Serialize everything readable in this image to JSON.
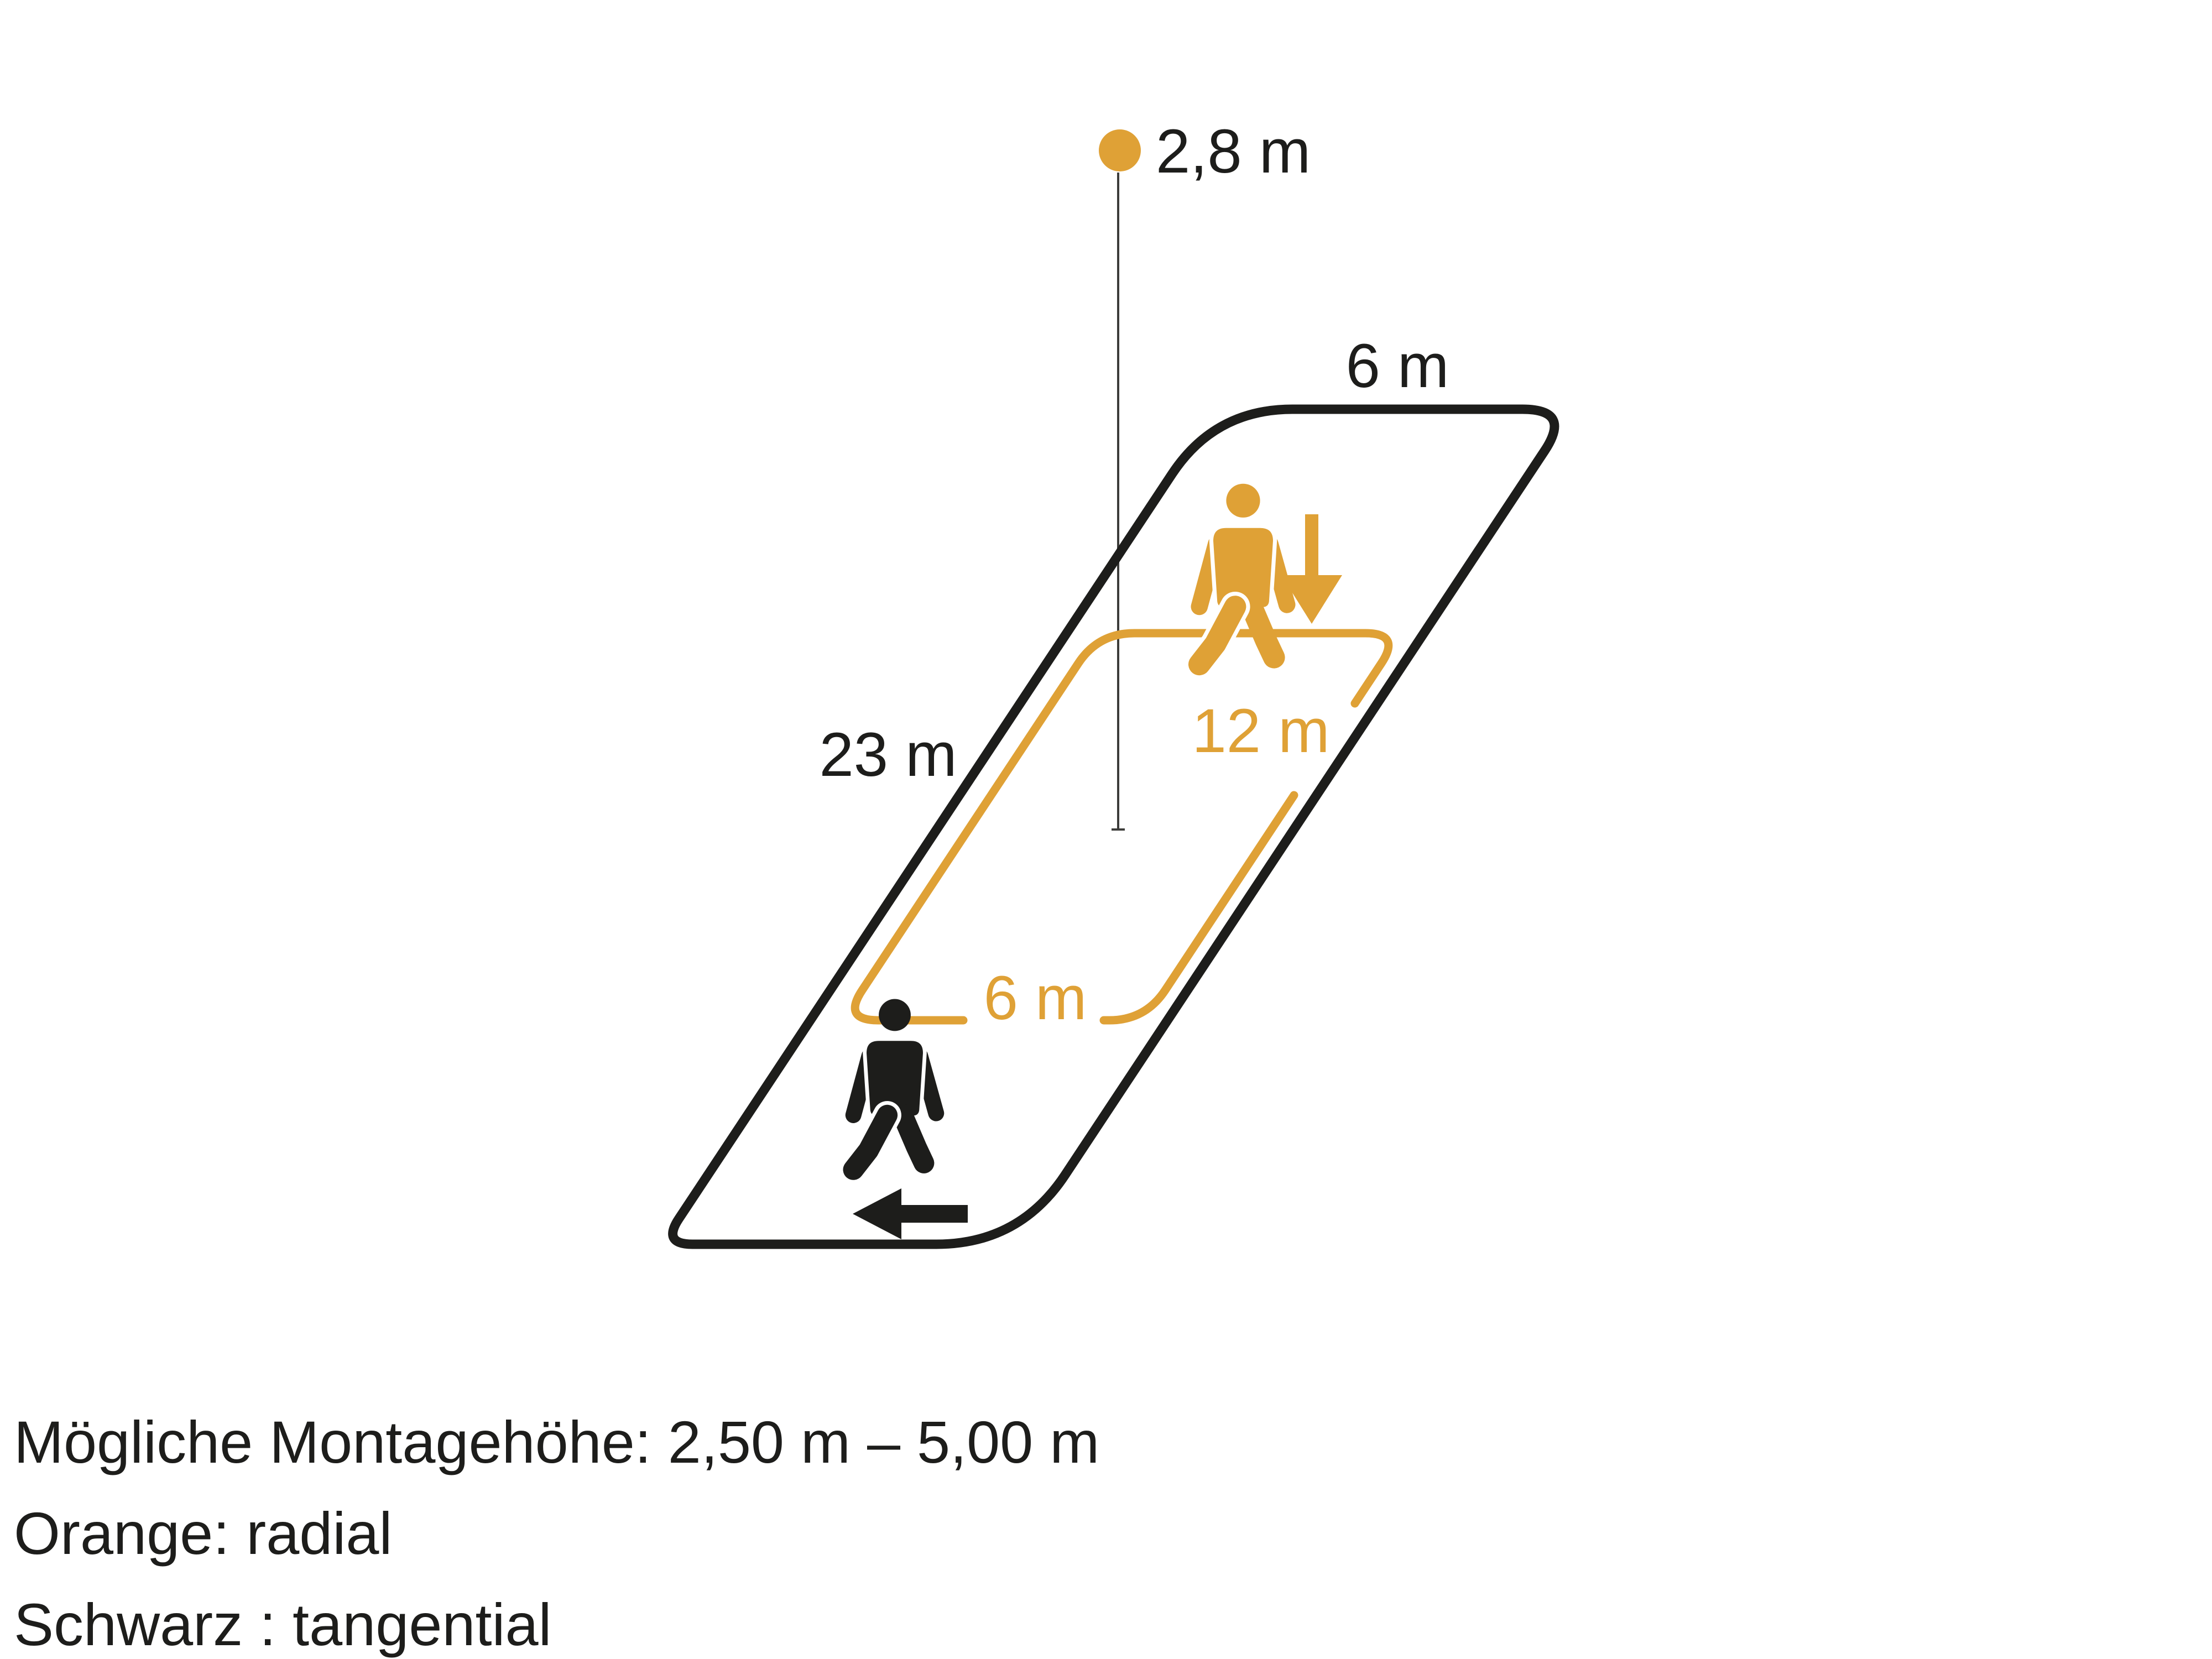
{
  "colors": {
    "orange": "#DFA136",
    "black": "#1D1D1B",
    "line_gray": "#3D3D3B",
    "background": "#FFFFFF"
  },
  "diagram": {
    "mounting_height_label": "2,8 m",
    "outer_zone": {
      "width_label": "6 m",
      "length_label": "23 m"
    },
    "inner_zone": {
      "length_label": "12 m",
      "width_label": "6 m"
    }
  },
  "footer": {
    "line1": "Mögliche Montagehöhe: 2,50 m – 5,00 m",
    "line2": "Orange: radial",
    "line3": "Schwarz : tangential"
  }
}
